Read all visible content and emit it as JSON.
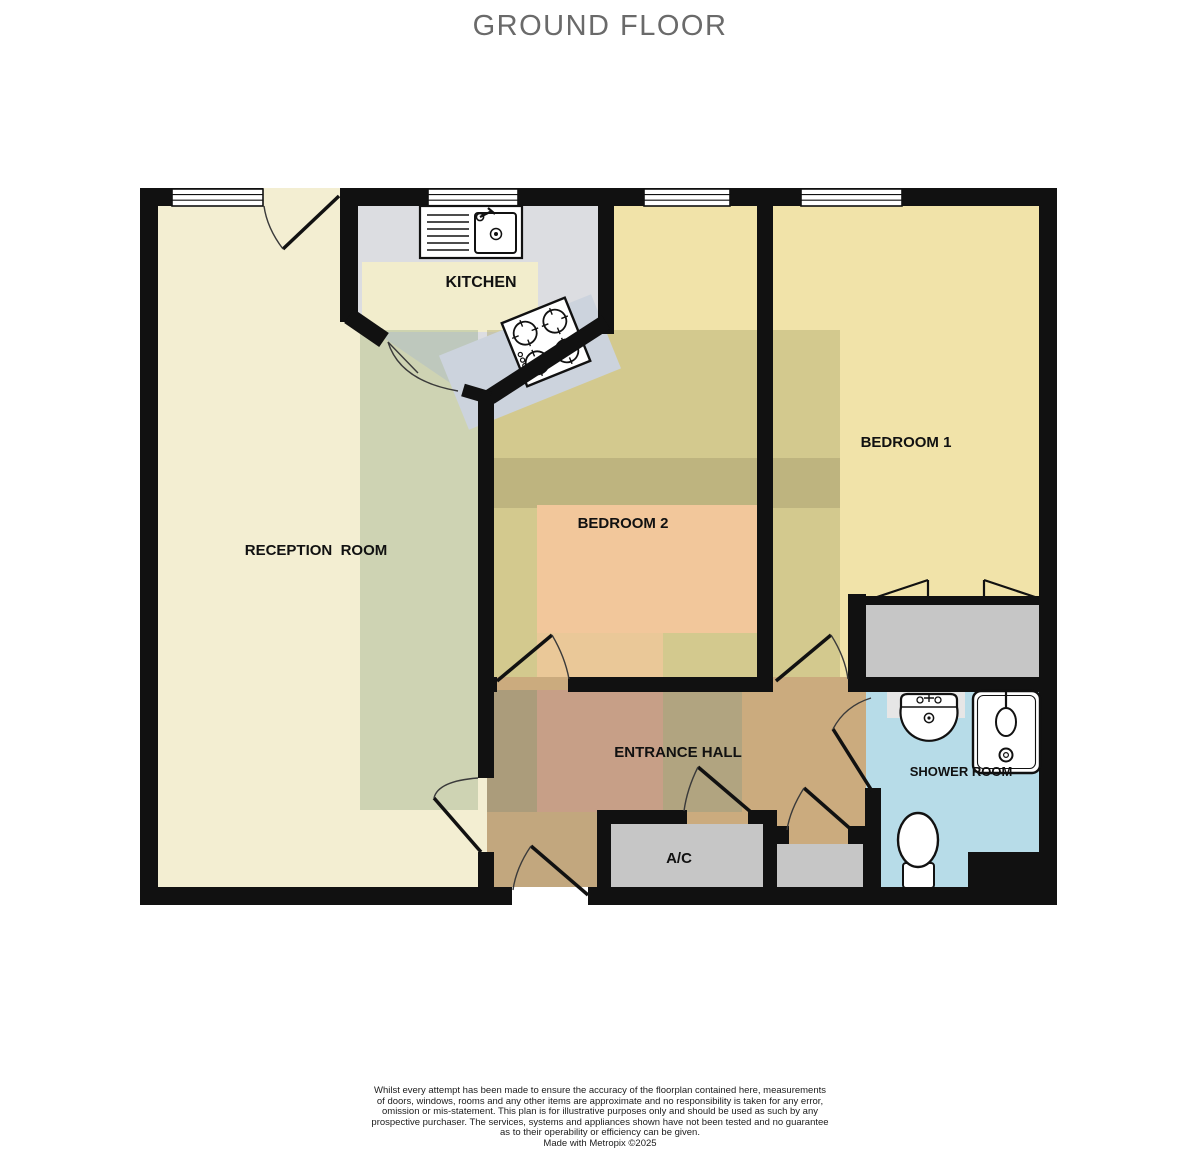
{
  "title": "GROUND FLOOR",
  "rooms": {
    "reception": {
      "label": "RECEPTION  ROOM"
    },
    "kitchen": {
      "label": "KITCHEN"
    },
    "bedroom1": {
      "label": "BEDROOM 1"
    },
    "bedroom2": {
      "label": "BEDROOM 2"
    },
    "hall": {
      "label": "ENTRANCE HALL"
    },
    "shower": {
      "label": "SHOWER ROOM"
    },
    "ac": {
      "label": "A/C"
    }
  },
  "colors": {
    "wall": "#111111",
    "reception_floor": "#f3eed2",
    "bedroom_floor": "#f1e3a9",
    "kitchen_floor": "#dcdde1",
    "kitchen_band": "#f2edcc",
    "peach_zone": "#f2c79b",
    "hall_floor": "#cbab7e",
    "hall_rosy": "#c79f87",
    "shower_floor": "#b7dce8",
    "closet_gray": "#c6c6c6",
    "counter": "#ccd3dd",
    "title_gray": "#6a6a6a"
  },
  "footer": {
    "lines": [
      "Whilst every attempt has been made to ensure the accuracy of the floorplan contained here, measurements",
      "of doors, windows, rooms and any other items are approximate and no responsibility is taken for any error,",
      "omission or mis-statement. This plan is for illustrative purposes only and should be used as such by any",
      "prospective purchaser. The services, systems and appliances shown have not been tested and no guarantee",
      "as to their operability or efficiency can be given.",
      "Made with Metropix ©2025"
    ]
  }
}
